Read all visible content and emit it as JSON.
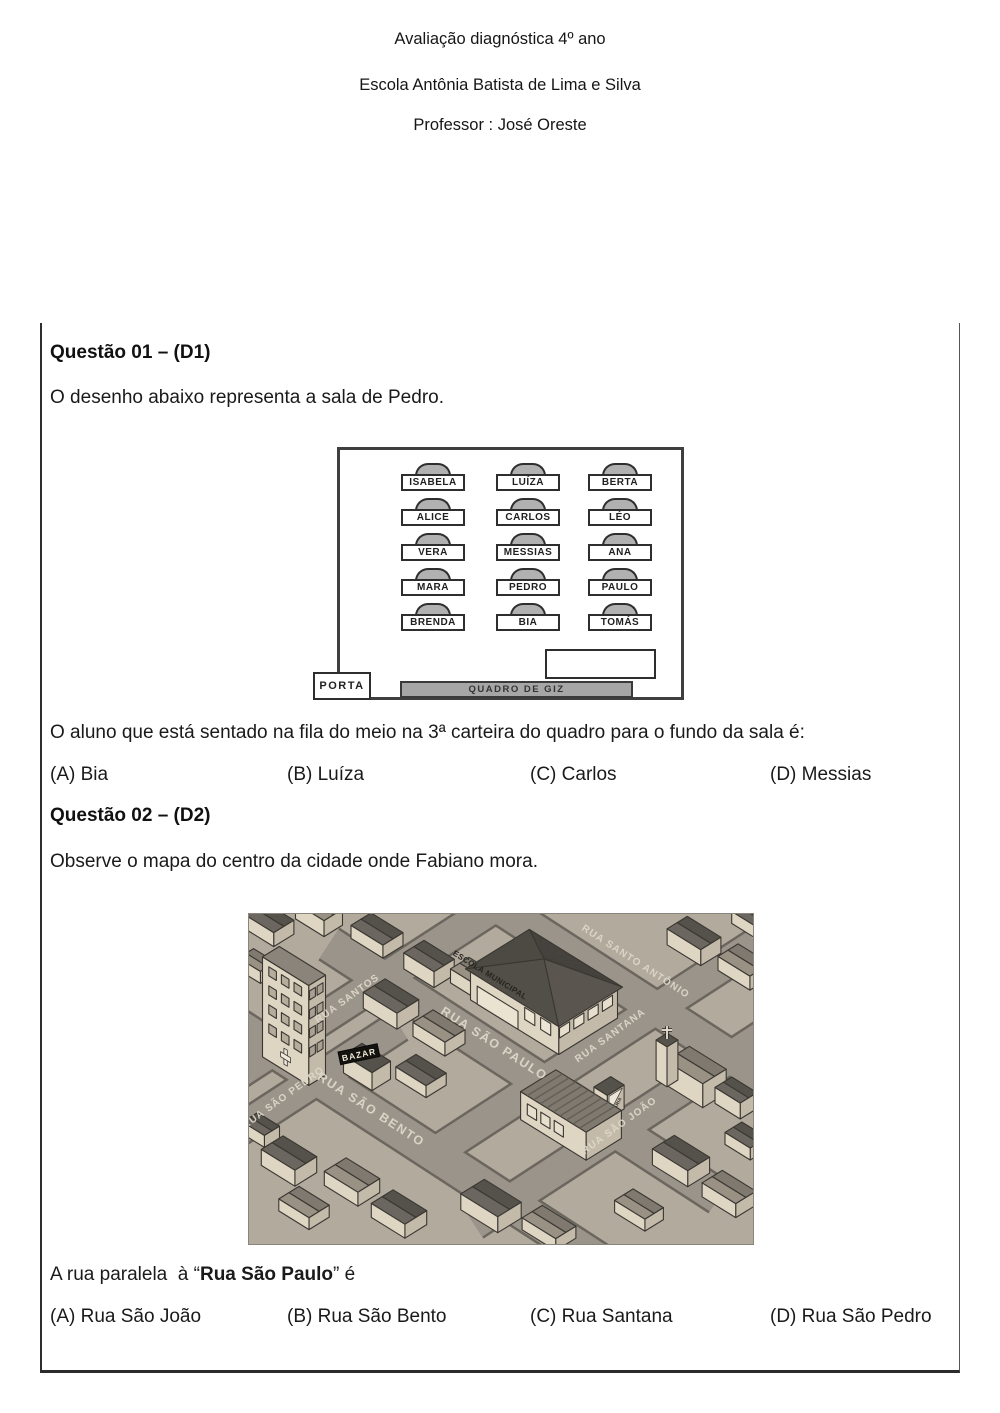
{
  "header": {
    "title": "Avaliação diagnóstica 4º ano",
    "school": "Escola Antônia Batista de Lima e Silva",
    "professor": "Professor : José Oreste"
  },
  "q1": {
    "title": "Questão 01 – (D1)",
    "intro": "O desenho abaixo representa a sala de Pedro.",
    "classroom": {
      "rows": [
        [
          "ISABELA",
          "LUÍZA",
          "BERTA"
        ],
        [
          "ALICE",
          "CARLOS",
          "LÉO"
        ],
        [
          "VERA",
          "MESSIAS",
          "ANA"
        ],
        [
          "MARA",
          "PEDRO",
          "PAULO"
        ],
        [
          "BRENDA",
          "BIA",
          "TOMÁS"
        ]
      ],
      "door": "PORTA",
      "board": "QUADRO DE GIZ"
    },
    "prompt": "O aluno que está sentado na fila do meio na 3ª carteira do quadro para o fundo da sala é:",
    "options": [
      {
        "key": "(A)",
        "text": "Bia"
      },
      {
        "key": "(B)",
        "text": "Luíza"
      },
      {
        "key": "(C)",
        "text": "Carlos"
      },
      {
        "key": "(D)",
        "text": "Messias"
      }
    ]
  },
  "q2": {
    "title": "Questão 02 – (D2)",
    "intro": "Observe o mapa do centro da cidade onde Fabiano mora.",
    "map": {
      "streets": {
        "santos": "RUA SANTOS",
        "santo_antonio": "RUA SANTO ANTÔNIO",
        "sao_paulo": "RUA SÃO PAULO",
        "santana": "RUA SANTANA",
        "sao_pedro": "RUA SÃO PEDRO",
        "sao_bento": "RUA SÃO BENTO",
        "sao_joao": "RUA SÃO JOÃO"
      },
      "buildings": {
        "school": "ESCOLA MUNICIPAL",
        "bazar": "BAZAR",
        "padaria": "PADARIA"
      },
      "colors": {
        "street": "#9b948a",
        "block": "#b2aa9d",
        "curb": "#6b665e",
        "wall": "#ded5c3",
        "wall_shade": "#c3baa9",
        "roof_dark": "#55514b",
        "roof_mid": "#7f796f",
        "label": "#ded8ca",
        "outline": "#3a3732"
      }
    },
    "prompt": {
      "prefix": "A rua paralela  à “",
      "bold": "Rua São Paulo",
      "suffix": "” é"
    },
    "options": [
      {
        "key": "(A)",
        "text": "Rua São João"
      },
      {
        "key": "(B)",
        "text": "Rua São Bento"
      },
      {
        "key": "(C)",
        "text": "Rua Santana"
      },
      {
        "key": "(D)",
        "text": "Rua São Pedro"
      }
    ]
  }
}
